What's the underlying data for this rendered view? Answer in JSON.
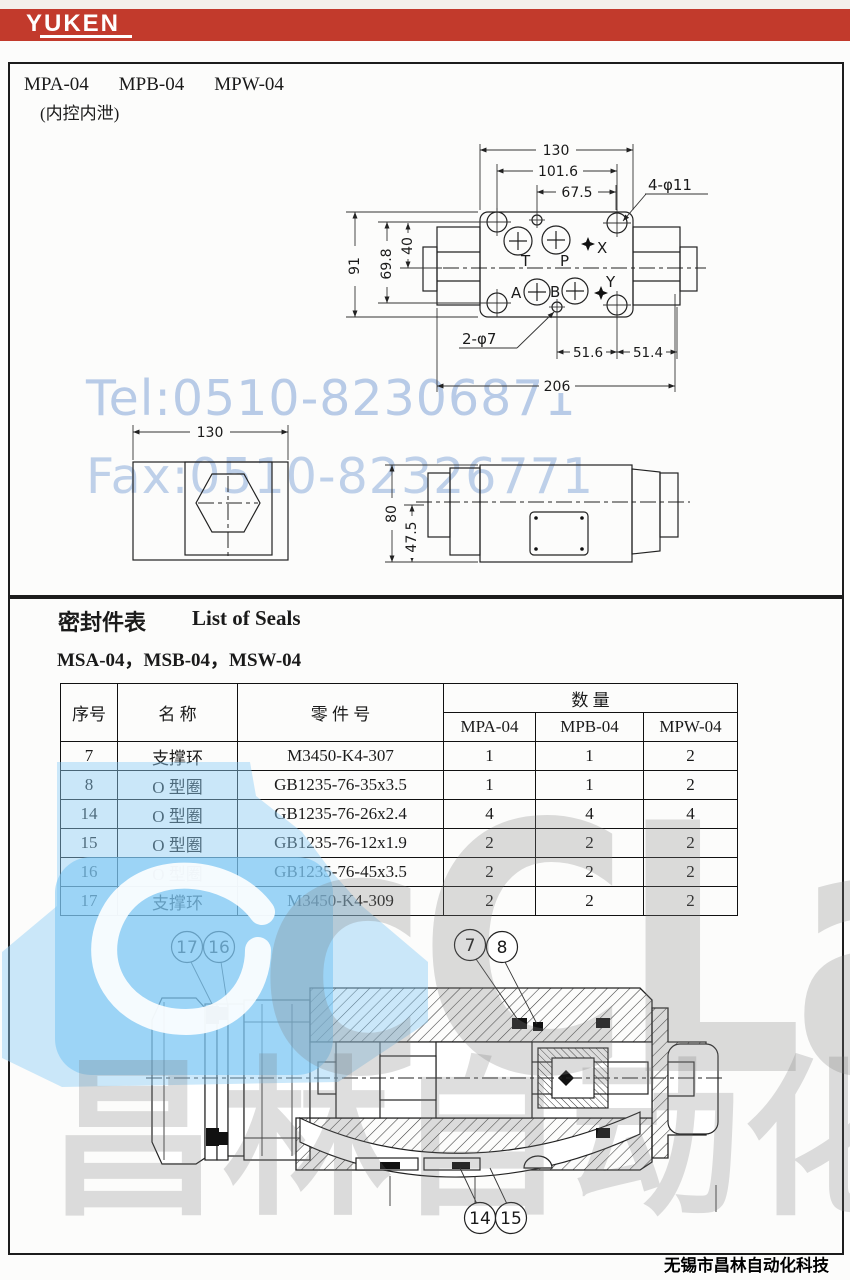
{
  "header": {
    "brand": "YUKEN"
  },
  "section1": {
    "models": [
      "MPA-04",
      "MPB-04",
      "MPW-04"
    ],
    "subtitle": "(内控内泄)",
    "plan": {
      "d130": "130",
      "d1016": "101.6",
      "d675": "67.5",
      "d4p11": "4-φ11",
      "d91": "91",
      "d698": "69.8",
      "d40": "40",
      "d2p7": "2-φ7",
      "d516": "51.6",
      "d514": "51.4",
      "d206": "206",
      "pt": "T",
      "pp": "P",
      "px": "X",
      "pa": "A",
      "pb": "B",
      "py": "Y"
    },
    "end_view": {
      "d130": "130"
    },
    "side_view": {
      "d80": "80",
      "d475": "47.5"
    }
  },
  "section2": {
    "title_cn": "密封件表",
    "title_en": "List of Seals",
    "models_line": "MSA-04，MSB-04，MSW-04",
    "table": {
      "h_seq": "序号",
      "h_name": "名 称",
      "h_part": "零 件 号",
      "h_qty": "数 量",
      "cols": [
        "MPA-04",
        "MPB-04",
        "MPW-04"
      ],
      "rows": [
        [
          "7",
          "支撑环",
          "M3450-K4-307",
          "1",
          "1",
          "2"
        ],
        [
          "8",
          "O 型圈",
          "GB1235-76-35x3.5",
          "1",
          "1",
          "2"
        ],
        [
          "14",
          "O 型圈",
          "GB1235-76-26x2.4",
          "4",
          "4",
          "4"
        ],
        [
          "15",
          "O 型圈",
          "GB1235-76-12x1.9",
          "2",
          "2",
          "2"
        ],
        [
          "16",
          "O 型圈",
          "GB1235-76-45x3.5",
          "2",
          "2",
          "2"
        ],
        [
          "17",
          "支撑环",
          "M3450-K4-309",
          "2",
          "2",
          "2"
        ]
      ]
    },
    "callouts": {
      "c17": "17",
      "c16": "16",
      "c7": "7",
      "c8": "8",
      "c14": "14",
      "c15": "15"
    }
  },
  "watermark": {
    "tel": "Tel:0510-82306871",
    "fax": "Fax:0510-82326771",
    "brand": "cCLair",
    "brand_cn": "昌林自动化"
  },
  "footer": {
    "company": "无锡市昌林自动化科技"
  },
  "colors": {
    "header_red": "#c23a2c",
    "watermark_blue_text": "#80a3d7",
    "watermark_sky": "#8fd0f4",
    "watermark_gray": "#828282"
  }
}
